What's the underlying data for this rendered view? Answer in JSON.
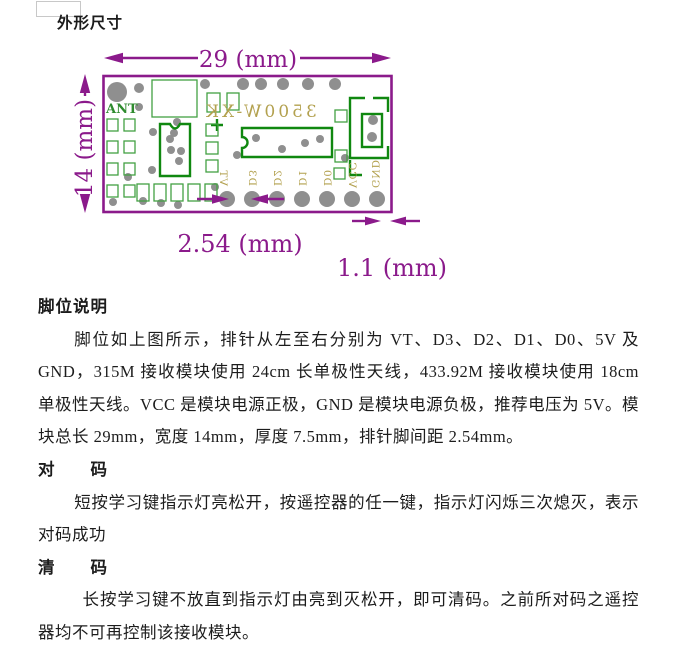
{
  "page": {
    "title": "外形尺寸"
  },
  "diagram": {
    "dim_length_label": "29  (mm)",
    "dim_width_label": "14  (mm)",
    "dim_pitch_label": "2.54  (mm)",
    "dim_pad_label": "1.1  (mm)",
    "ant_label": "ANT",
    "silk_model_text": "3500W-XK",
    "pin_labels": [
      "VT",
      "D3",
      "D2",
      "D1",
      "D0",
      "VCC",
      "GND"
    ],
    "colors": {
      "dimension_purple": "#8B1A8B",
      "silk_green_strong": "#108810",
      "silk_green_light": "#43A043",
      "silk_olive": "#B3A14F",
      "pad_gray": "#8F8F8F"
    }
  },
  "sections": [
    {
      "heading": "脚位说明",
      "body": "脚位如上图所示，排针从左至右分别为 VT、D3、D2、D1、D0、5V 及 GND，315M 接收模块使用 24cm 长单极性天线，433.92M 接收模块使用 18cm 单极性天线。VCC 是模块电源正极，GND 是模块电源负极，推荐电压为 5V。模块总长 29mm，宽度 14mm，厚度 7.5mm，排针脚间距 2.54mm。"
    },
    {
      "heading": "对　　码",
      "body": "短按学习键指示灯亮松开，按遥控器的任一键，指示灯闪烁三次熄灭，表示对码成功"
    },
    {
      "heading": "清　　码",
      "body": "长按学习键不放直到指示灯由亮到灭松开，即可清码。之前所对码之遥控器均不可再控制该接收模块。"
    }
  ]
}
